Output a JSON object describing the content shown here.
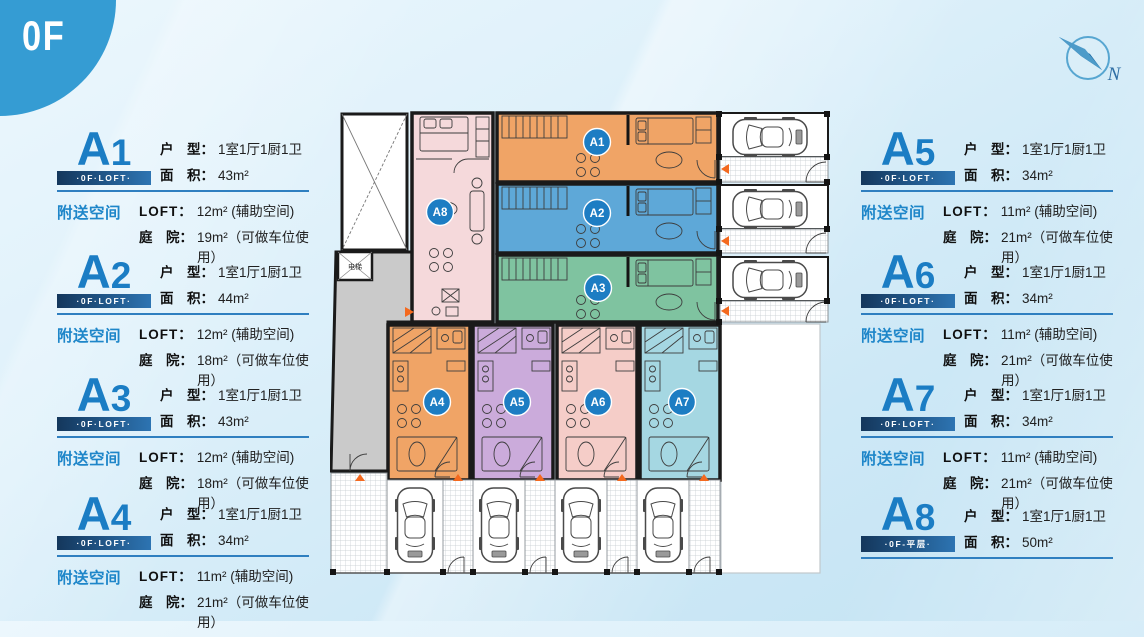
{
  "logo": {
    "text": "0F"
  },
  "compass": {
    "label": "N"
  },
  "labels": {
    "type": "户　型：",
    "area": "面　积：",
    "bonus": "附送空间",
    "loft": "LOFT：",
    "yard": "庭　院："
  },
  "panels": [
    {
      "code_letter": "A",
      "code_num": "1",
      "ribbon": "·0F·LOFT·",
      "type": "1室1厅1厨1卫",
      "area": "43m²",
      "loft": "12m² (辅助空间)",
      "yard": "19m²（可做车位使用）"
    },
    {
      "code_letter": "A",
      "code_num": "2",
      "ribbon": "·0F·LOFT·",
      "type": "1室1厅1厨1卫",
      "area": "44m²",
      "loft": "12m² (辅助空间)",
      "yard": "18m²（可做车位使用）"
    },
    {
      "code_letter": "A",
      "code_num": "3",
      "ribbon": "·0F·LOFT·",
      "type": "1室1厅1厨1卫",
      "area": "43m²",
      "loft": "12m² (辅助空间)",
      "yard": "18m²（可做车位使用）"
    },
    {
      "code_letter": "A",
      "code_num": "4",
      "ribbon": "·0F·LOFT·",
      "type": "1室1厅1厨1卫",
      "area": "34m²",
      "loft": "11m² (辅助空间)",
      "yard": "21m²（可做车位使用）"
    },
    {
      "code_letter": "A",
      "code_num": "5",
      "ribbon": "·0F·LOFT·",
      "type": "1室1厅1厨1卫",
      "area": "34m²",
      "loft": "11m² (辅助空间)",
      "yard": "21m²（可做车位使用）"
    },
    {
      "code_letter": "A",
      "code_num": "6",
      "ribbon": "·0F·LOFT·",
      "type": "1室1厅1厨1卫",
      "area": "34m²",
      "loft": "11m² (辅助空间)",
      "yard": "21m²（可做车位使用）"
    },
    {
      "code_letter": "A",
      "code_num": "7",
      "ribbon": "·0F·LOFT·",
      "type": "1室1厅1厨1卫",
      "area": "34m²",
      "loft": "11m² (辅助空间)",
      "yard": "21m²（可做车位使用）"
    },
    {
      "code_letter": "A",
      "code_num": "8",
      "ribbon": "·0F-平层·",
      "type": "1室1厅1厨1卫",
      "area": "50m²"
    }
  ],
  "plan": {
    "badges": [
      "A1",
      "A2",
      "A3",
      "A4",
      "A5",
      "A6",
      "A7",
      "A8"
    ],
    "elevator_label": "电梯"
  },
  "colors": {
    "accent": "#1b7dc4",
    "ribbon_dark": "#14375c",
    "ribbon_light": "#2d74b2",
    "badge": "#1d7dc3",
    "divider": "#2f7fc0",
    "bonus_text": "#1e86c9",
    "logo_circle": "#359cd3",
    "entry_marker": "#f4691e",
    "unit_a1": "#f0a466",
    "unit_a2": "#5ea8d8",
    "unit_a3": "#7fc3a0",
    "unit_a4": "#f0a466",
    "unit_a5": "#cbabdb",
    "unit_a6": "#f5cdc8",
    "unit_a7": "#a5d7e2",
    "unit_a8": "#f5d9db",
    "corridor": "#cacaca"
  }
}
